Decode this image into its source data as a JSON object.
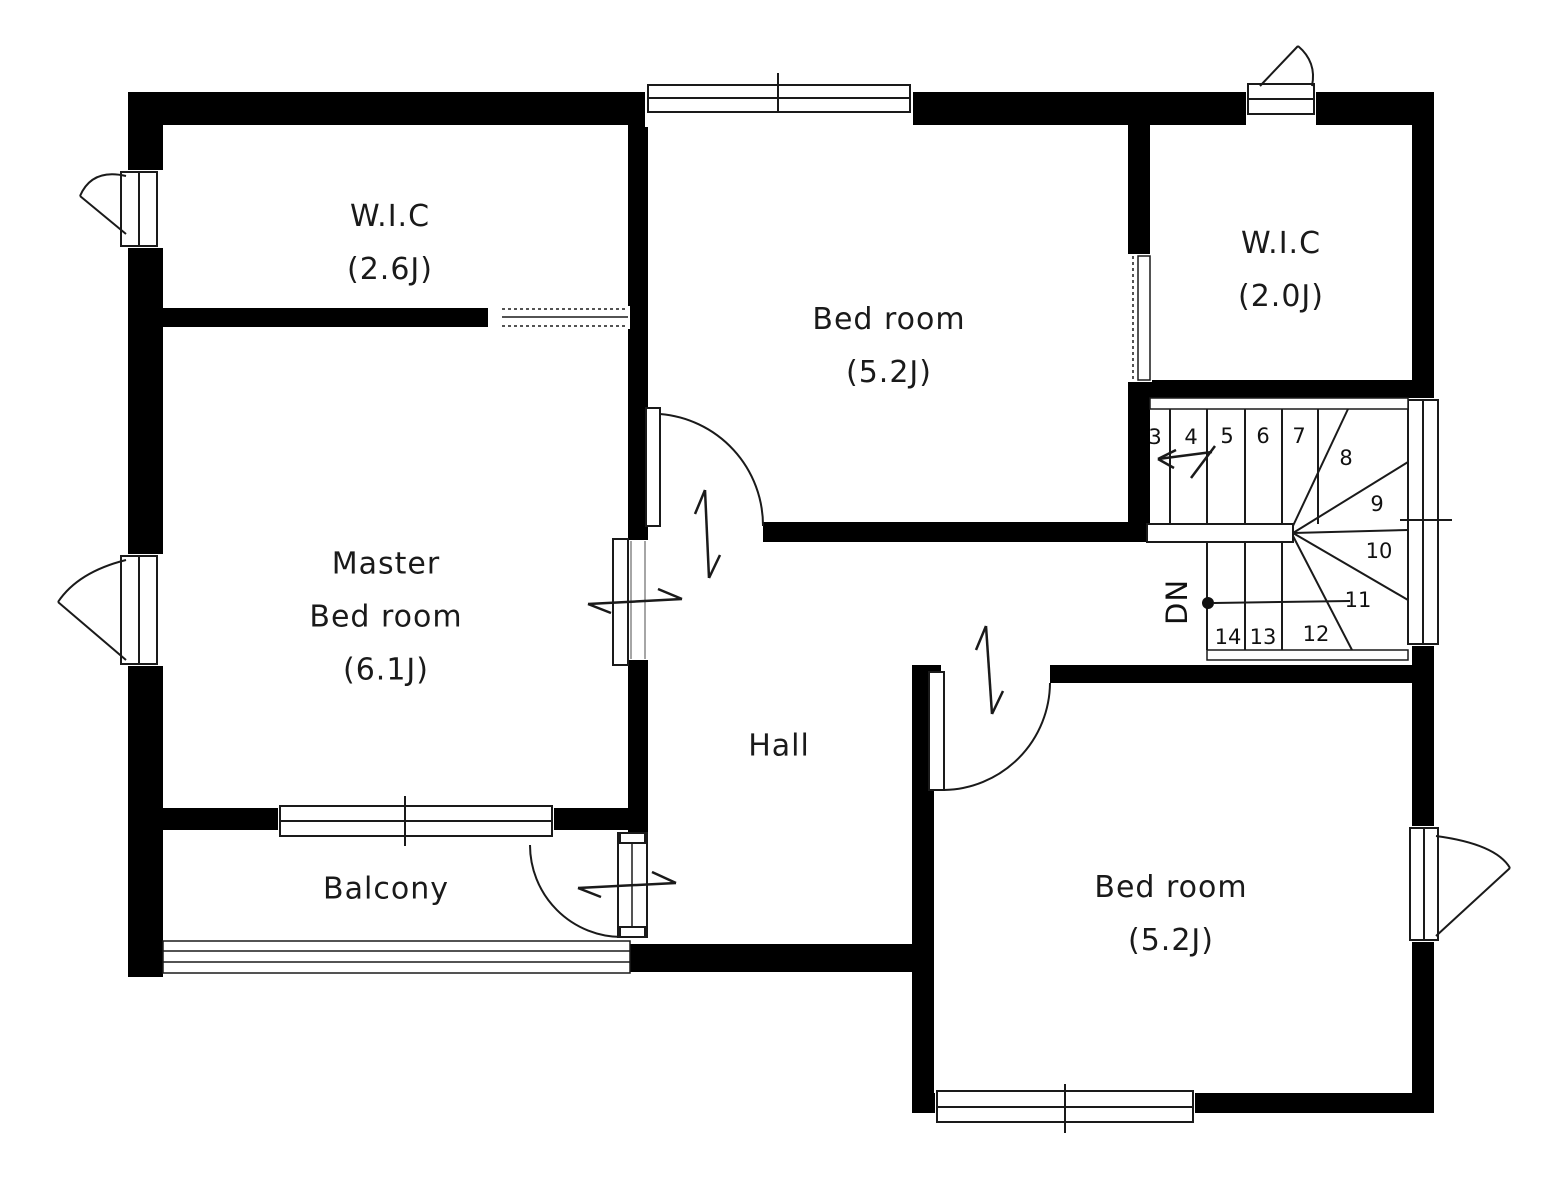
{
  "floorplan": {
    "rooms": {
      "wic_upper_left": {
        "name": "W.I.C",
        "size": "(2.6J)"
      },
      "bedroom_top": {
        "name": "Bed room",
        "size": "(5.2J)"
      },
      "wic_upper_right": {
        "name": "W.I.C",
        "size": "(2.0J)"
      },
      "master_bedroom": {
        "line1": "Master",
        "line2": "Bed room",
        "size": "(6.1J)"
      },
      "hall": {
        "name": "Hall"
      },
      "balcony": {
        "name": "Balcony"
      },
      "bedroom_bottom": {
        "name": "Bed room",
        "size": "(5.2J)"
      }
    },
    "stairs": {
      "direction_label": "DN",
      "step_numbers": [
        "3",
        "4",
        "5",
        "6",
        "7",
        "8",
        "9",
        "10",
        "11",
        "12",
        "13",
        "14"
      ]
    },
    "colors": {
      "wall": "#000000",
      "background": "#ffffff",
      "line": "#1a1a1a"
    }
  }
}
